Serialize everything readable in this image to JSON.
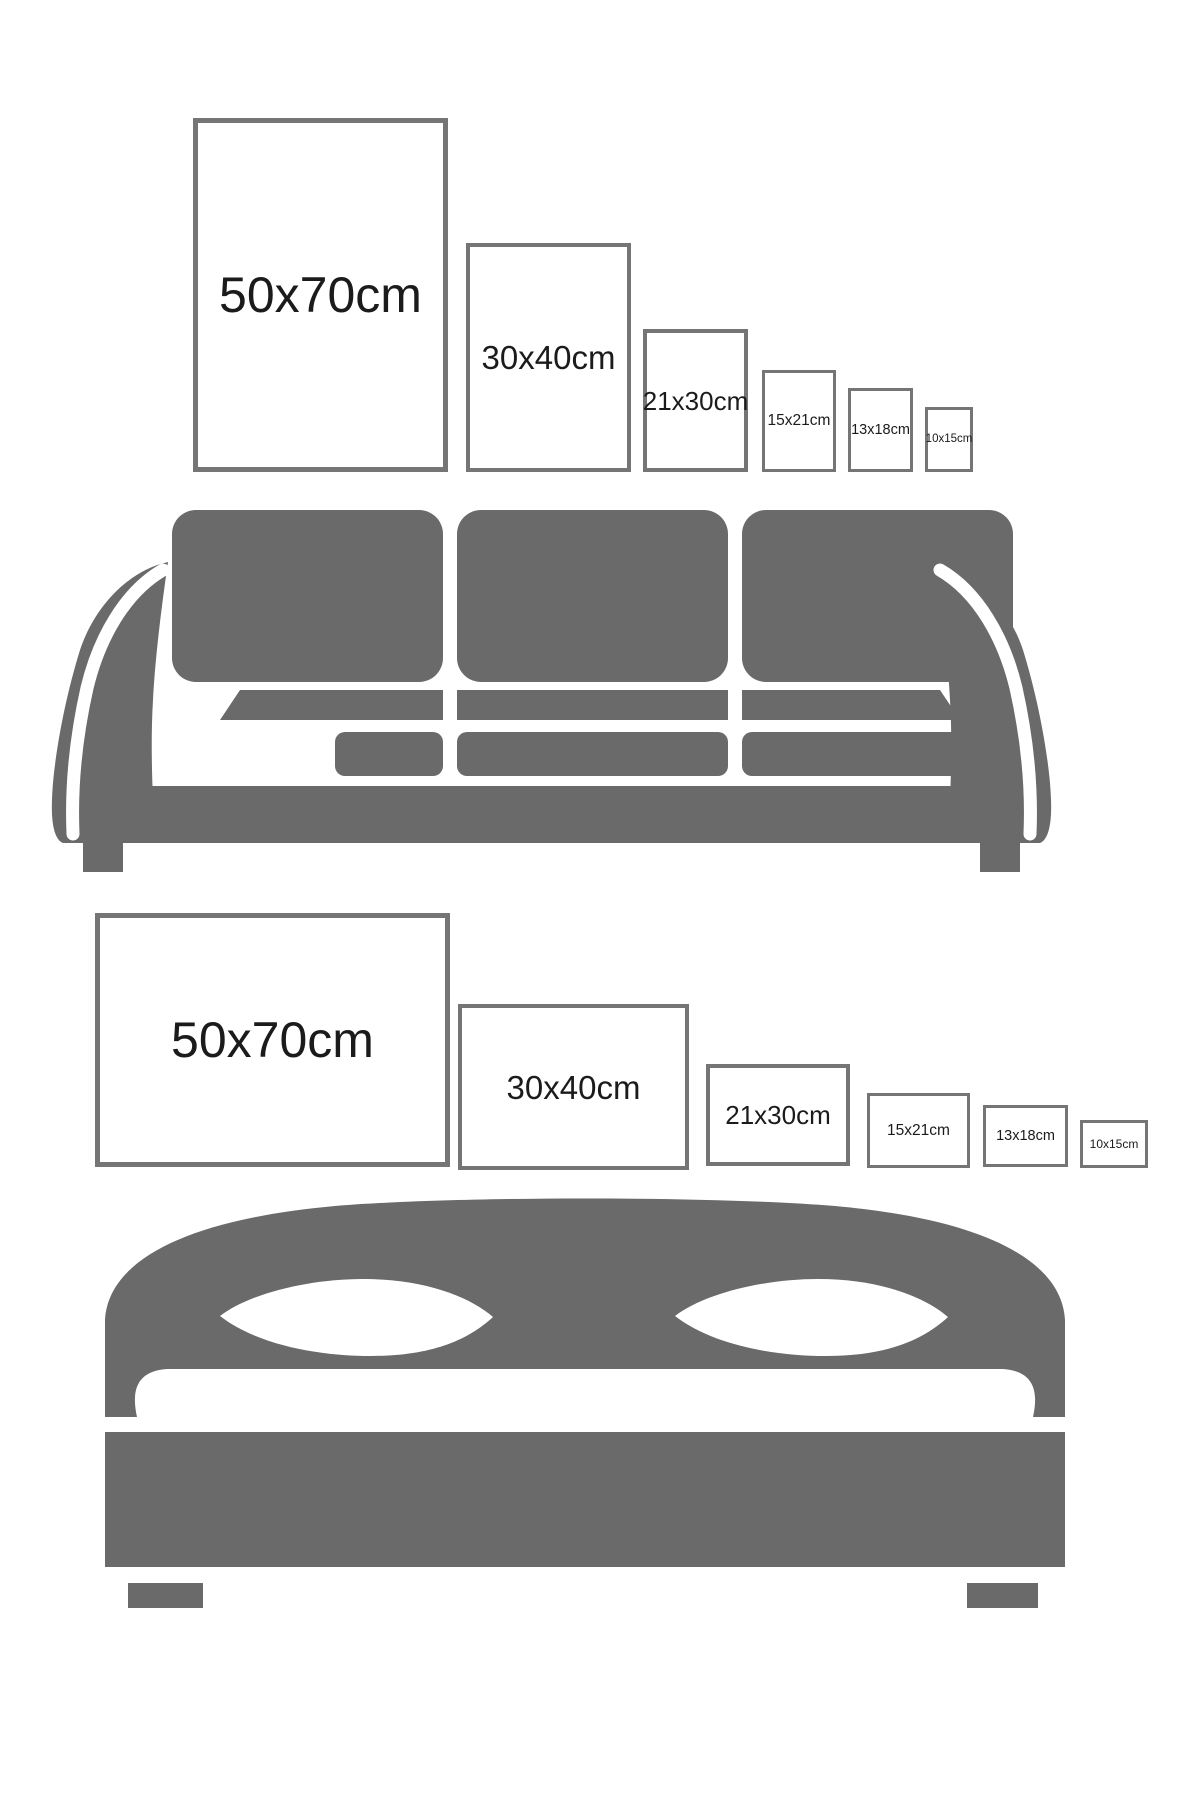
{
  "colors": {
    "furniture": "#6a6a6a",
    "frame_border": "#757575",
    "label": "#1b1b1b",
    "background": "#ffffff"
  },
  "portrait_size_guide": {
    "furniture": "sofa",
    "frames": [
      {
        "label": "50x70cm"
      },
      {
        "label": "30x40cm"
      },
      {
        "label": "21x30cm"
      },
      {
        "label": "15x21cm"
      },
      {
        "label": "13x18cm"
      },
      {
        "label": "10x15cm"
      }
    ]
  },
  "landscape_size_guide": {
    "furniture": "bed",
    "frames": [
      {
        "label": "50x70cm"
      },
      {
        "label": "30x40cm"
      },
      {
        "label": "21x30cm"
      },
      {
        "label": "15x21cm"
      },
      {
        "label": "13x18cm"
      },
      {
        "label": "10x15cm"
      }
    ]
  }
}
